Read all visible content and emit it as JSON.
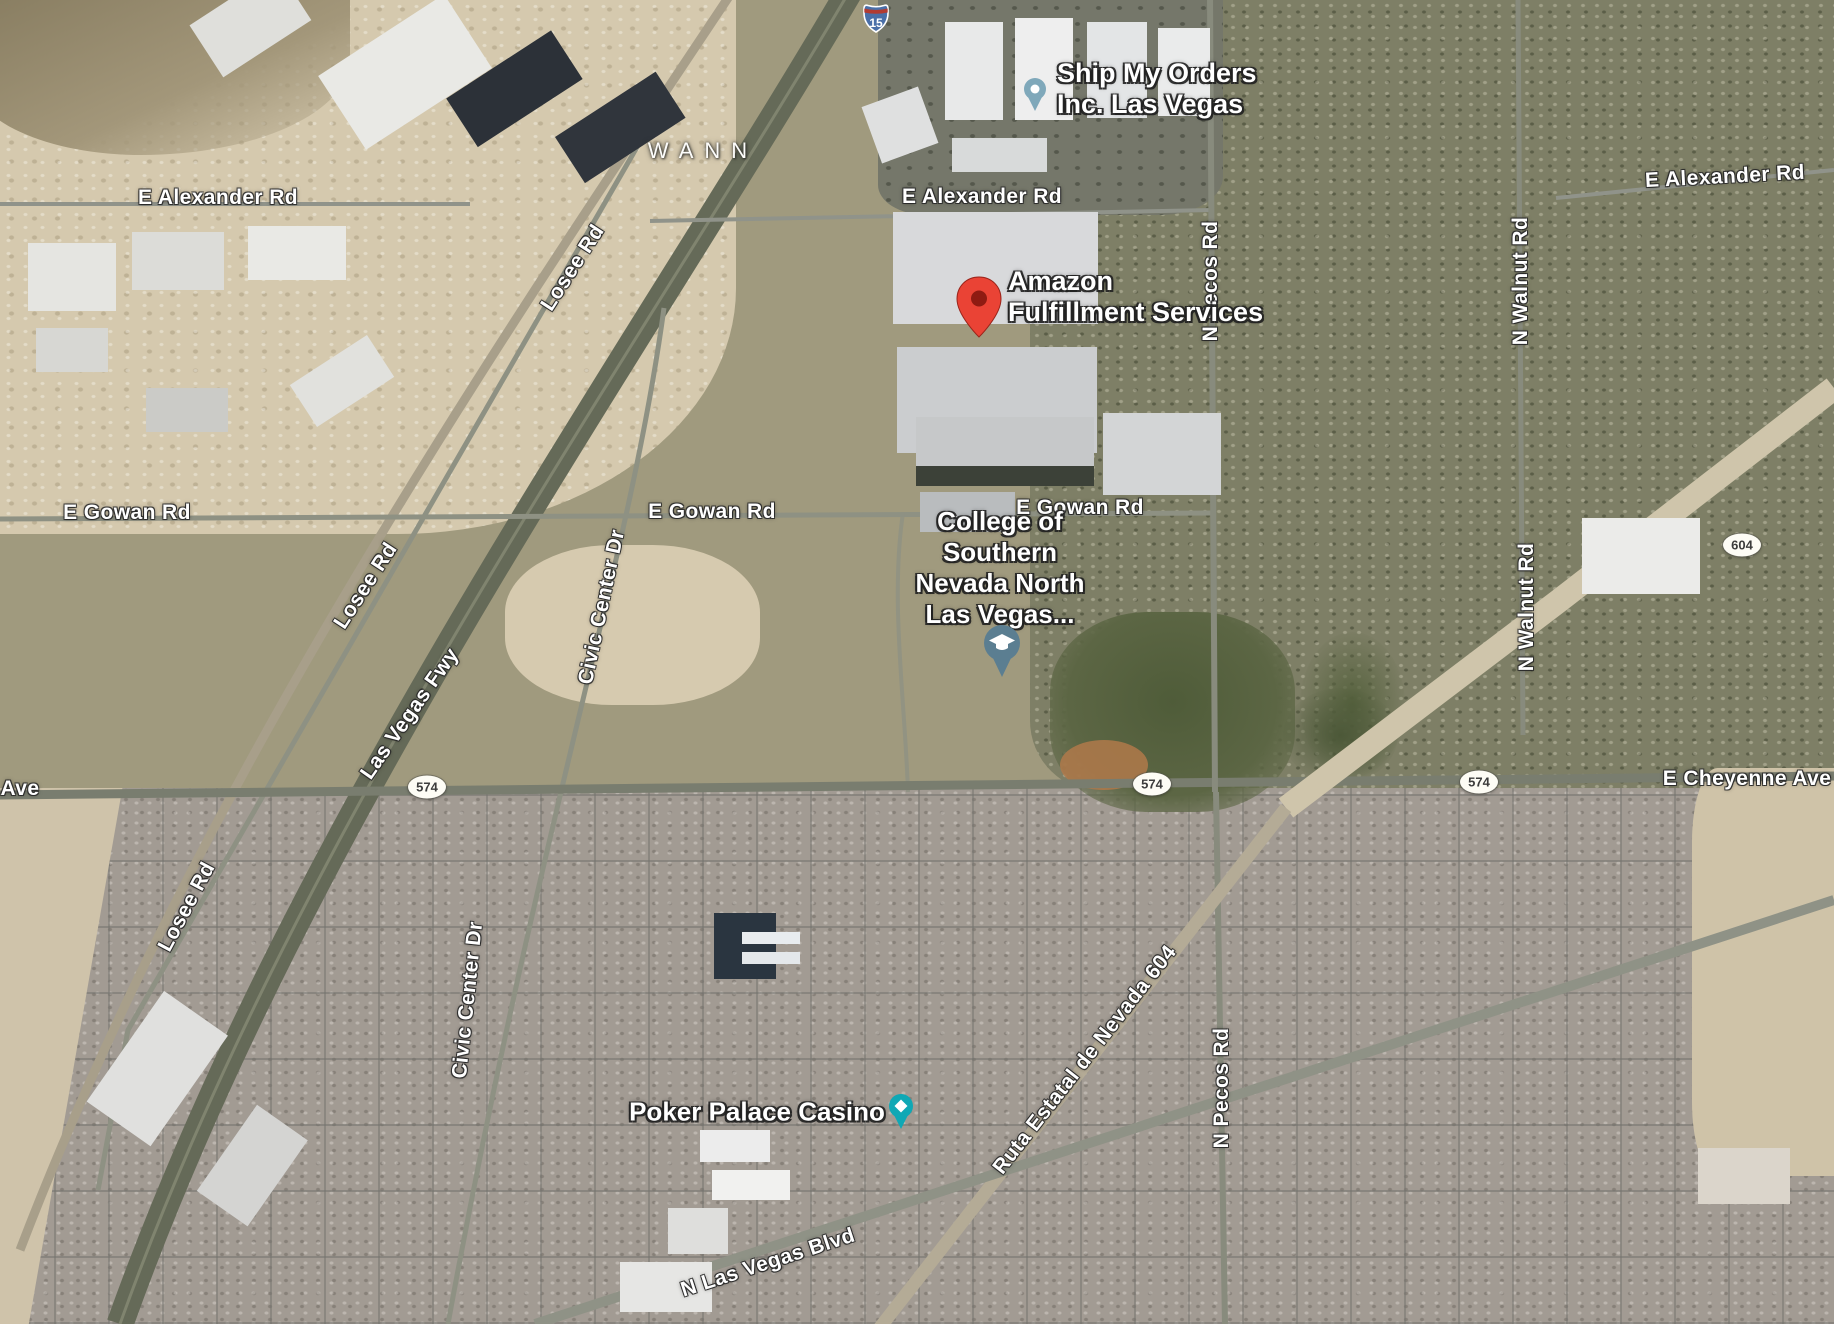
{
  "map": {
    "view": "satellite",
    "area_label": "WANN",
    "pois": {
      "ship_my_orders": {
        "line1": "Ship My Orders",
        "line2": "Inc. Las Vegas",
        "pin_color": "#7fa8ba"
      },
      "amazon_fulfillment": {
        "line1": "Amazon",
        "line2": "Fulfillment Services",
        "pin_color": "#EA4335"
      },
      "csn_north": {
        "line1": "College of",
        "line2": "Southern",
        "line3": "Nevada North",
        "line4": "Las Vegas...",
        "pin_color": "#5b7e91"
      },
      "poker_palace": {
        "name": "Poker Palace Casino",
        "pin_color": "#0fa8b5"
      }
    },
    "road_labels": {
      "alexander": "E Alexander Rd",
      "gowan": "E Gowan Rd",
      "cheyenne": "E Cheyenne Ave",
      "cheyenne_partial": "Ave",
      "losee": "Losee Rd",
      "las_vegas_fwy": "Las Vegas Fwy",
      "civic_center": "Civic Center Dr",
      "pecos": "N Pecos Rd",
      "walnut": "N Walnut Rd",
      "ruta_604": "Ruta Estatal de Nevada 604",
      "las_vegas_blvd": "N Las Vegas Blvd"
    },
    "shields": {
      "interstate_15": "15",
      "route_574": "574",
      "route_604": "604"
    }
  }
}
